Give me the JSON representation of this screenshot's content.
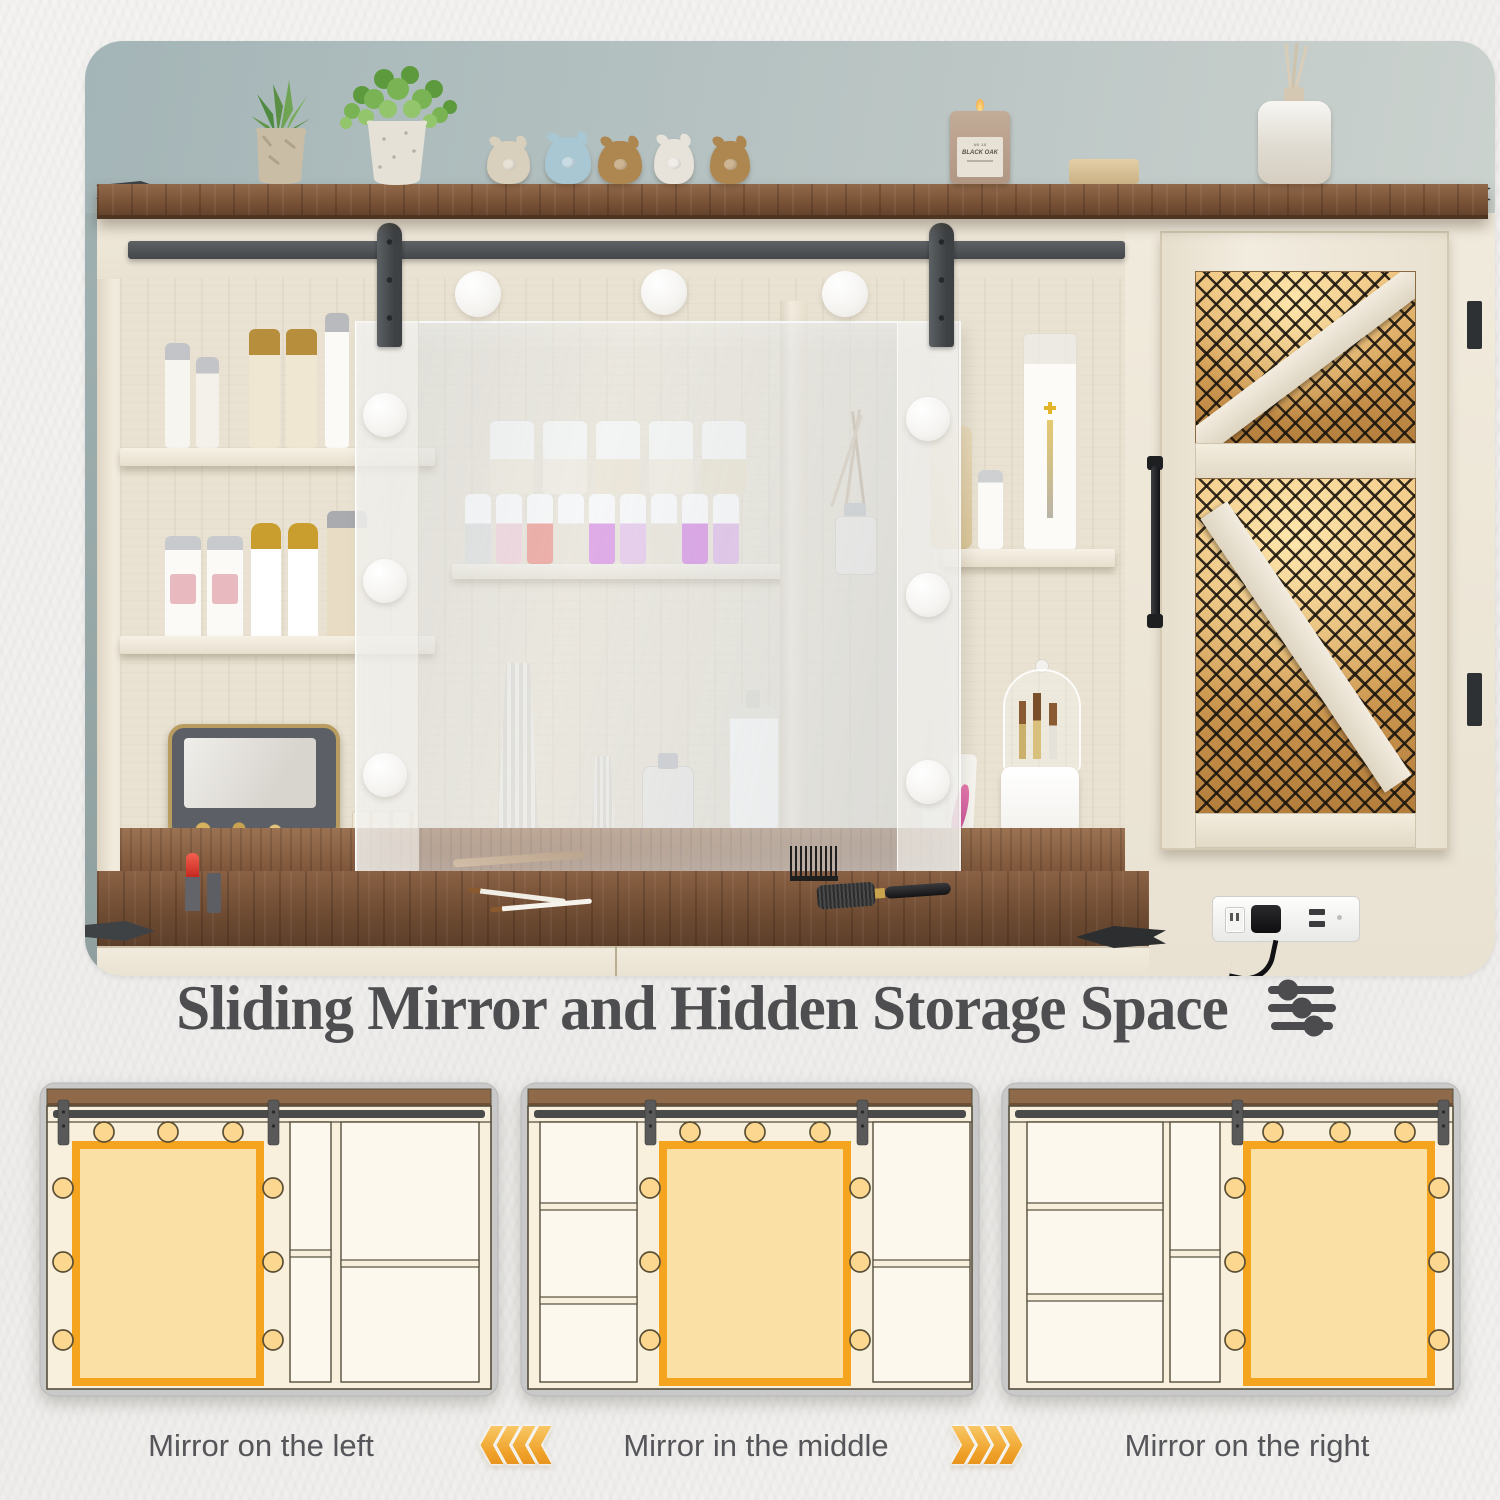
{
  "title": {
    "text": "Sliding Mirror and Hidden Storage Space",
    "icon": "sliders-icon"
  },
  "diagrams": [
    {
      "position": "left",
      "caption": "Mirror on the left"
    },
    {
      "position": "middle",
      "caption": "Mirror in the middle"
    },
    {
      "position": "right",
      "caption": "Mirror on the right"
    }
  ],
  "arrows": [
    {
      "direction": "left",
      "count": 4
    },
    {
      "direction": "right",
      "count": 4
    }
  ],
  "hero": {
    "candle_label": "BLACK OAK",
    "items": [
      "succulent-plant",
      "potted-plant",
      "pig-figurines",
      "scented-candle",
      "soap-bar",
      "reed-diffuser",
      "cosmetic-bottles",
      "nail-polish-collection",
      "jewelry-box",
      "makeup-brush-organizer",
      "sliding-mirror-panel",
      "vanity-light-bulbs",
      "barn-door-rail",
      "mesh-cabinet-door",
      "power-outlet-usb",
      "wood-countertop"
    ]
  },
  "colors": {
    "accent_orange": "#F5A41F",
    "mirror_fill": "#FBE0A6",
    "bulb_fill": "#FCD78F",
    "diagram_cream": "#F8F0DD",
    "diagram_bay": "#FDF8ED",
    "diagram_line": "#554E3C",
    "diagram_card": "#C9C9C9",
    "wood_brown": "#8E6A4A",
    "rail_gray": "#4A4A4A",
    "caption_text": "#56565A",
    "title_text": "#4E4E50"
  }
}
